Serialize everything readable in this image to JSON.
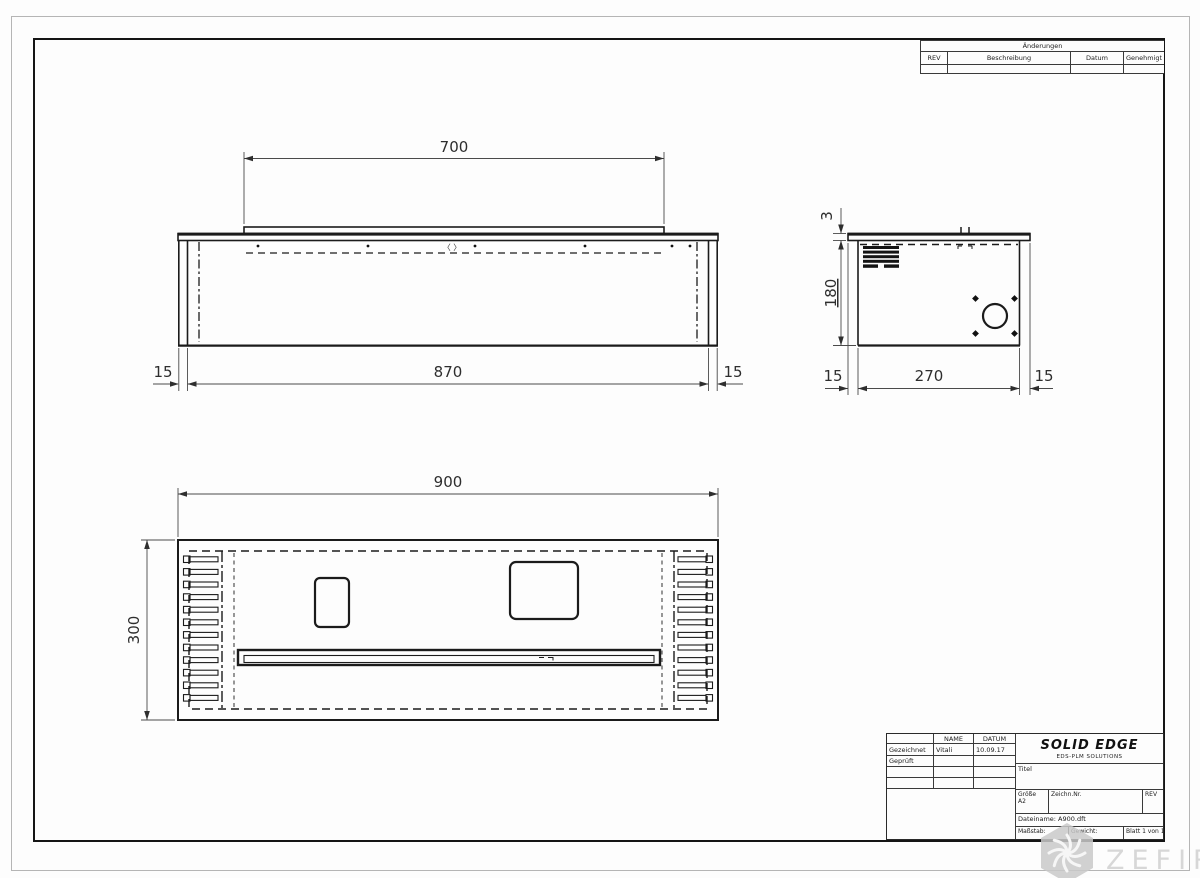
{
  "revision_table": {
    "title": "Änderungen",
    "col_rev": "REV",
    "col_desc": "Beschreibung",
    "col_date": "Datum",
    "col_approved": "Genehmigt"
  },
  "title_block": {
    "col_name": "NAME",
    "col_date": "DATUM",
    "row_drawn_label": "Gezeichnet",
    "row_drawn_name": "Vitali",
    "row_drawn_date": "10.09.17",
    "row_checked_label": "Geprüft",
    "brand": "SOLID EDGE",
    "brand_sub": "EDS-PLM SOLUTIONS",
    "title_label": "Titel",
    "size_label": "Größe",
    "size_value": "A2",
    "drawing_no_label": "Zeichn.Nr.",
    "rev_label": "REV",
    "filename": "Dateiname: A900.dft",
    "scale_label": "Maßstab:",
    "weight_label": "Gewicht:",
    "sheet_info": "Blatt 1 von 1"
  },
  "watermark": {
    "text": "ZEFIRE"
  },
  "views": {
    "front": {
      "dim_top": "700",
      "dim_body": "870",
      "dim_flange_left": "15",
      "dim_flange_right": "15",
      "center_mark": "〈 〉"
    },
    "side": {
      "dim_plate": "3",
      "dim_height": "180",
      "dim_flange_left": "15",
      "dim_depth": "270",
      "dim_flange_right": "15"
    },
    "top": {
      "dim_width": "900",
      "dim_depth": "300"
    }
  }
}
